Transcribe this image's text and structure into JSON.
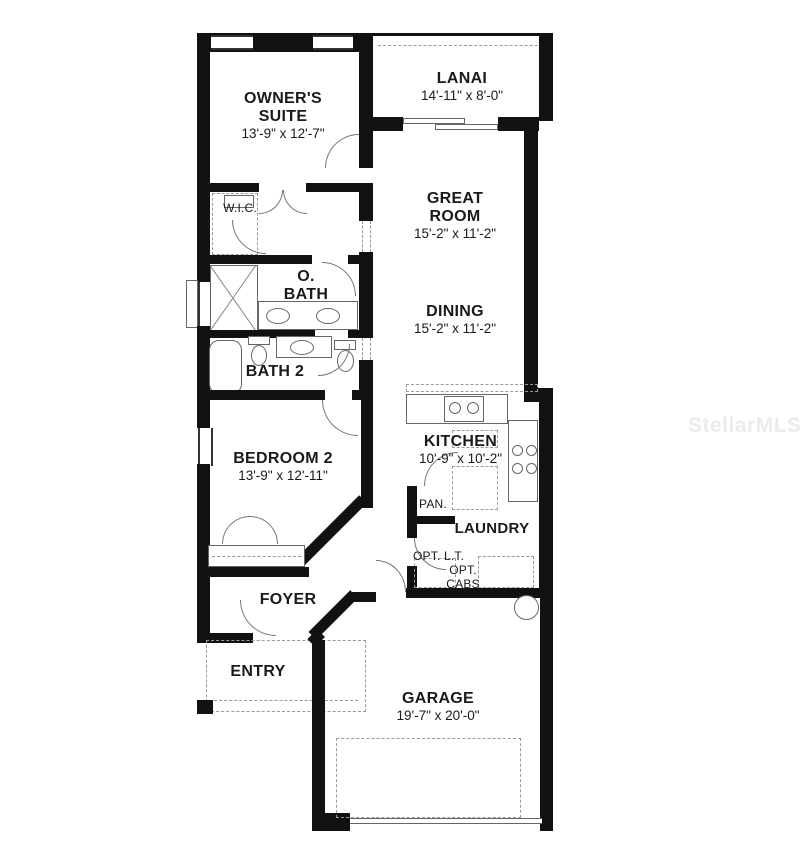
{
  "watermark": "StellarMLS",
  "rooms": {
    "owners_suite": {
      "name": "OWNER'S SUITE",
      "dims": "13'-9\" x 12'-7\""
    },
    "lanai": {
      "name": "LANAI",
      "dims": "14'-11\" x 8'-0\""
    },
    "great_room": {
      "name": "GREAT ROOM",
      "dims": "15'-2\" x 11'-2\""
    },
    "dining": {
      "name": "DINING",
      "dims": "15'-2\" x 11'-2\""
    },
    "wic": {
      "name": "W.I.C."
    },
    "o_bath": {
      "name": "O. BATH"
    },
    "bath2": {
      "name": "BATH 2"
    },
    "bedroom2": {
      "name": "BEDROOM 2",
      "dims": "13'-9\" x 12'-11\""
    },
    "kitchen": {
      "name": "KITCHEN",
      "dims": "10'-9\" x 10'-2\""
    },
    "pantry": {
      "name": "PAN."
    },
    "laundry": {
      "name": "LAUNDRY"
    },
    "opt_lt": {
      "name": "OPT. L.T."
    },
    "opt_cabs": {
      "name": "OPT. CABS"
    },
    "foyer": {
      "name": "FOYER"
    },
    "entry": {
      "name": "ENTRY"
    },
    "garage": {
      "name": "GARAGE",
      "dims": "19'-7\" x 20'-0\""
    }
  },
  "colors": {
    "wall": "#111111",
    "fixture_line": "#666666",
    "dashed": "#999999",
    "text": "#1a1a1a",
    "watermark": "#ebebeb"
  }
}
